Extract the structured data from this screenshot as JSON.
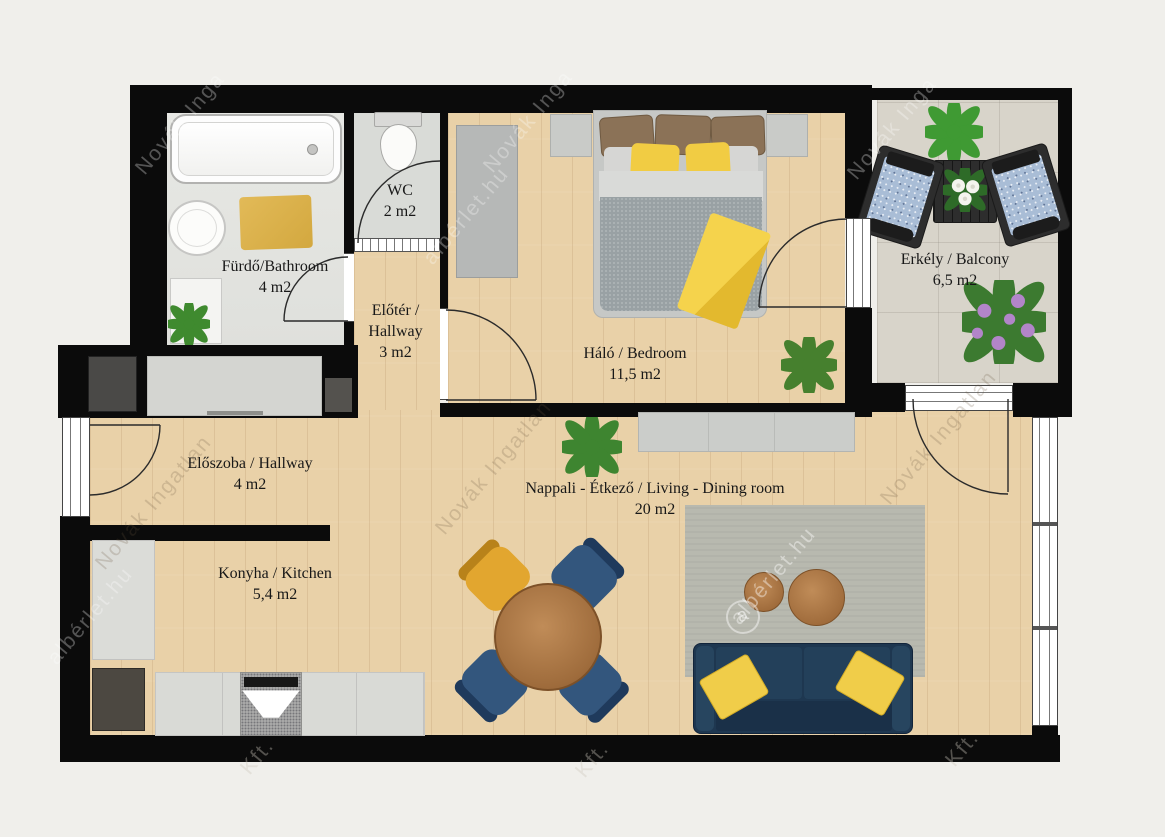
{
  "plan": {
    "title": "Apartment floor plan",
    "rooms": {
      "bathroom": {
        "name": "Fürdő/Bathroom",
        "area": "4 m2"
      },
      "wc": {
        "name": "WC",
        "area": "2 m2"
      },
      "vestibule": {
        "name_line1": "Előtér /",
        "name_line2": "Hallway",
        "area": "3 m2"
      },
      "bedroom": {
        "name": "Háló / Bedroom",
        "area": "11,5 m2"
      },
      "balcony": {
        "name": "Erkély / Balcony",
        "area": "6,5 m2"
      },
      "hallway": {
        "name": "Előszoba / Hallway",
        "area": "4 m2"
      },
      "living_dining": {
        "name": "Nappali - Étkező / Living - Dining room",
        "area": "20 m2"
      },
      "kitchen": {
        "name": "Konyha / Kitchen",
        "area": "5,4 m2"
      }
    },
    "furniture": {
      "bathroom": [
        "bathtub",
        "washbasin",
        "bath-mat",
        "cabinet",
        "plant"
      ],
      "wc": [
        "toilet"
      ],
      "vestibule": [],
      "bedroom": [
        "wardrobe",
        "double-bed",
        "nightstand-left",
        "nightstand-right",
        "yellow-throw",
        "plant"
      ],
      "balcony": [
        "armchair-left",
        "armchair-right",
        "table-with-flowers",
        "plant",
        "flowering-plant"
      ],
      "hallway": [
        "shoe-cabinet",
        "wardrobe"
      ],
      "kitchen": [
        "tall-cabinet",
        "refrigerator",
        "counter",
        "stove"
      ],
      "living_dining": [
        "sideboard",
        "plant",
        "dining-table",
        "dining-chair-yellow",
        "dining-chair-navy-1",
        "dining-chair-navy-2",
        "dining-chair-navy-3",
        "rug",
        "coffee-table-small",
        "coffee-table-large",
        "sofa",
        "sofa-pillows"
      ]
    },
    "colors": {
      "wall": "#0b0b0b",
      "background": "#f0efeb",
      "wood_floor": "#e9d1a8",
      "bathroom_tile": "#e5e6e2",
      "balcony_tile": "#d8d4ca",
      "accent_yellow": "#f2cd45",
      "sofa_navy": "#1e3750",
      "chair_navy": "#33567d",
      "rug_gray": "#b8b9af",
      "furniture_wood": "#b5814e"
    },
    "watermarks": [
      {
        "text": "Novák Inga"
      },
      {
        "text": "Novák Inga"
      },
      {
        "text": "Novák Inga"
      },
      {
        "text": "albérlet.hu"
      },
      {
        "text": "albérlet.hu"
      },
      {
        "text": "Novák Ingatlan"
      },
      {
        "text": "Novák Ingatlan"
      },
      {
        "text": "Novák Ingatlan"
      },
      {
        "text": "albérlet.hu"
      },
      {
        "text": "a"
      },
      {
        "text": "Kft."
      },
      {
        "text": "Kft."
      },
      {
        "text": "Kft."
      }
    ]
  }
}
